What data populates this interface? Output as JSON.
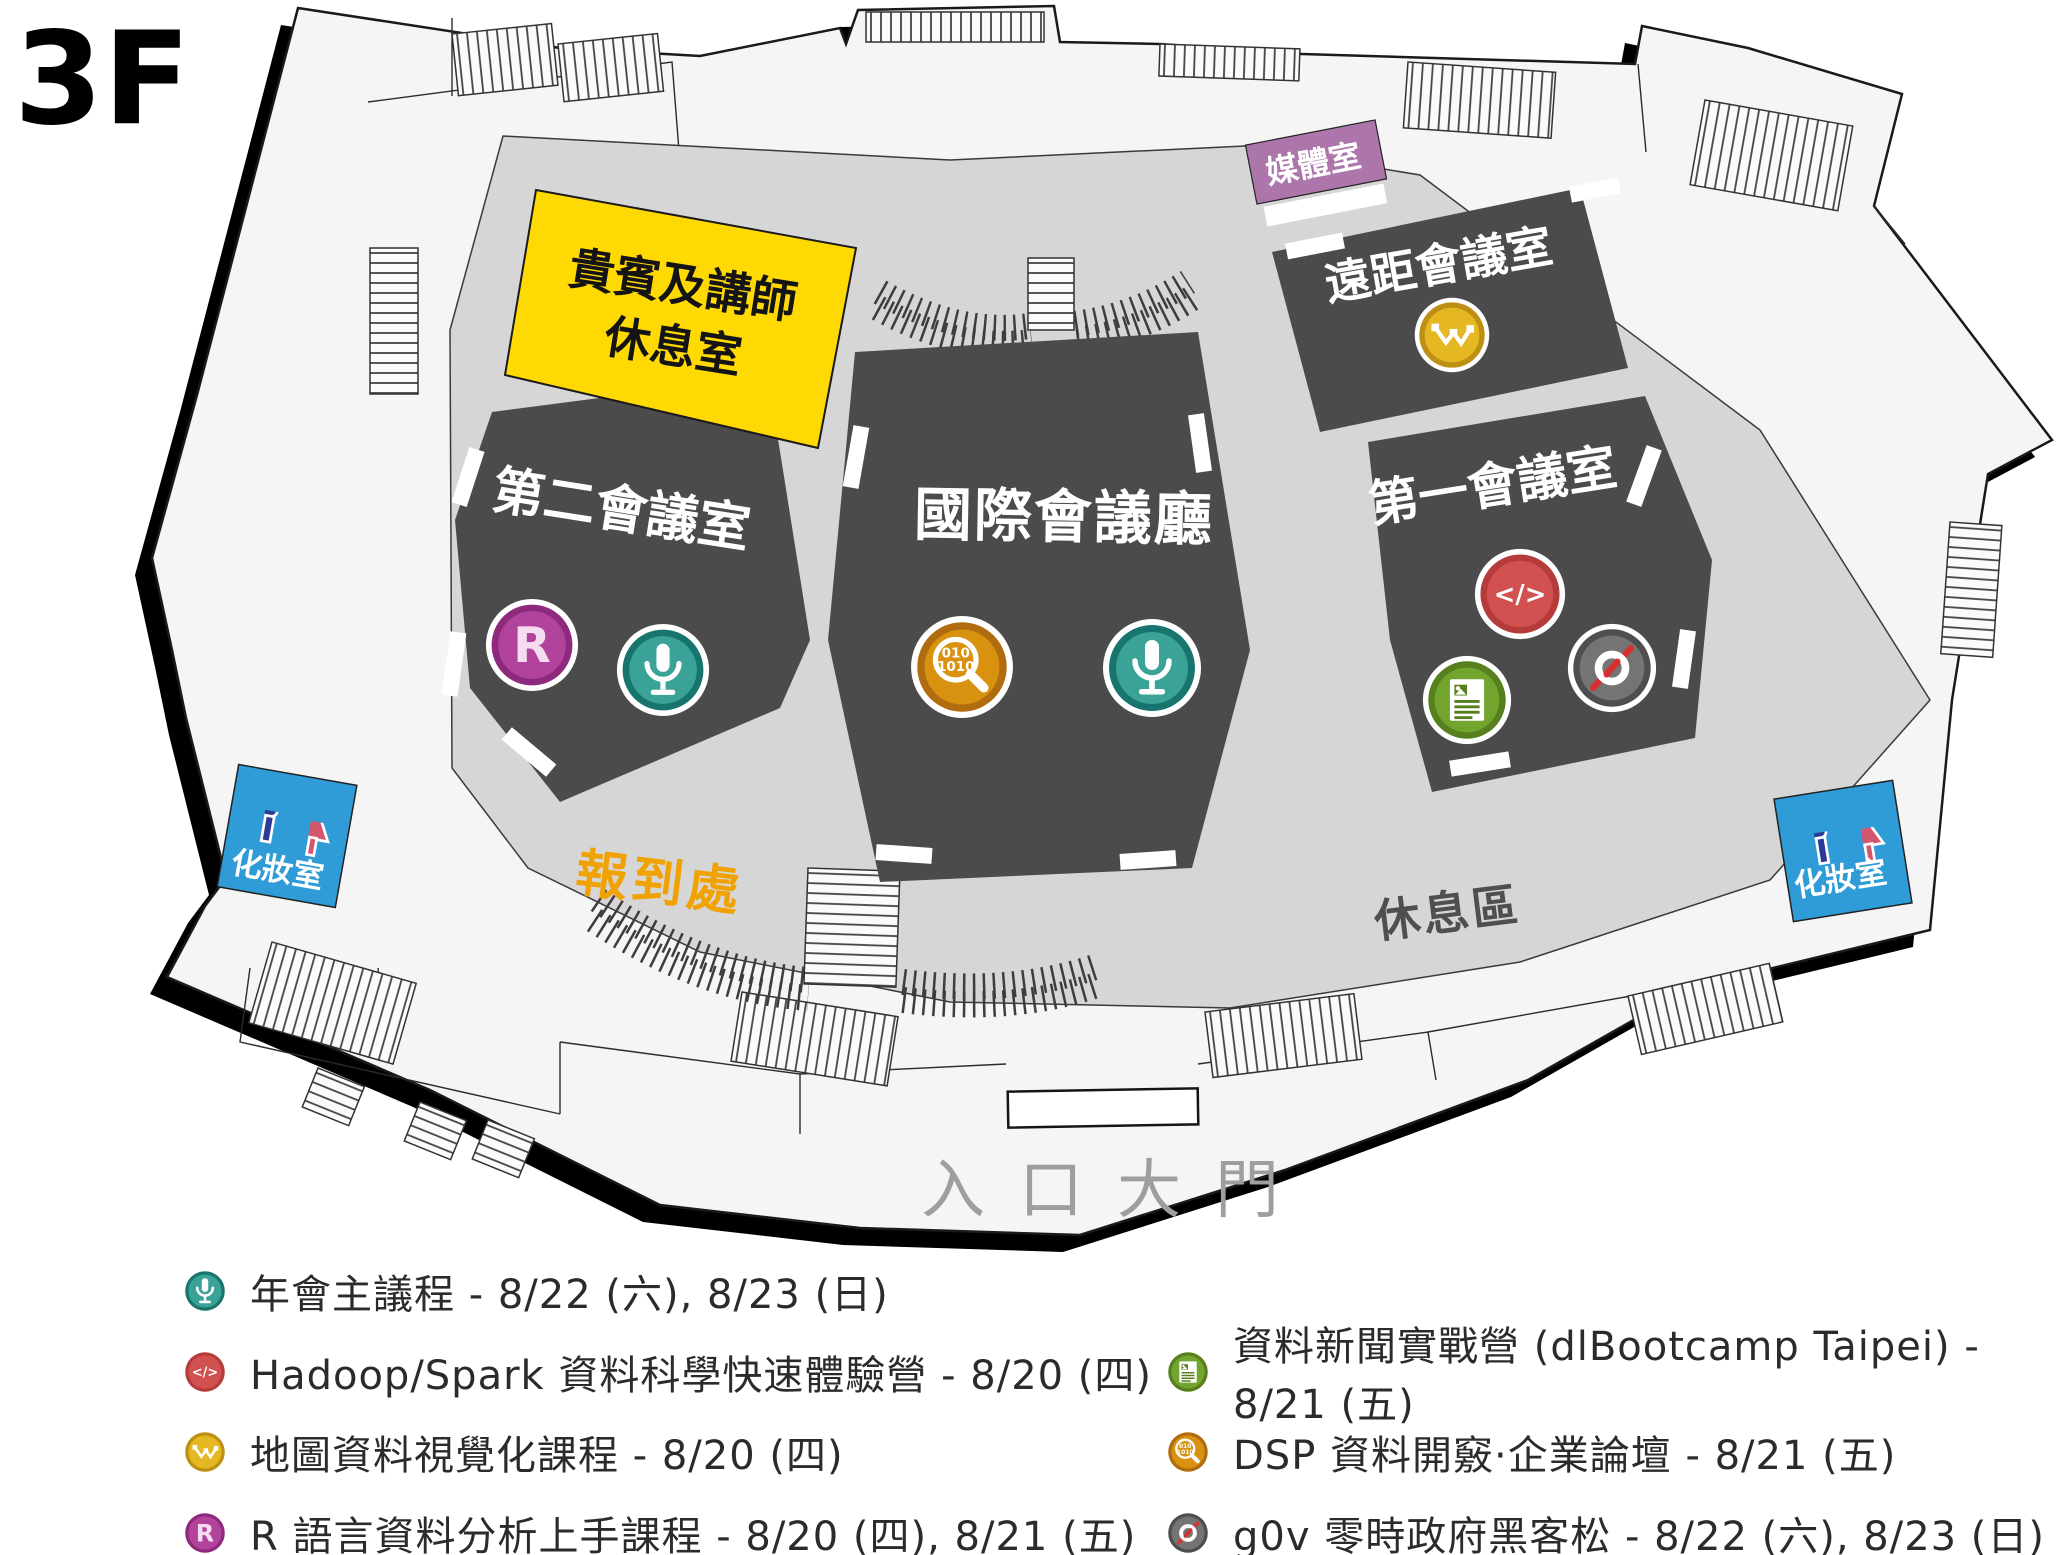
{
  "floor_label": "3F",
  "rooms": {
    "vip_lounge": {
      "line1": "貴賓及講師",
      "line2": "休息室",
      "color": "#ffd903"
    },
    "media_room": {
      "label": "媒體室",
      "color": "#ad76ab"
    },
    "remote_meeting_room": {
      "label": "遠距會議室",
      "icons": [
        "map-viz-icon"
      ]
    },
    "second_meeting_room": {
      "label": "第二會議室",
      "icons": [
        "r-lang-icon",
        "mic-icon"
      ]
    },
    "international_hall": {
      "label": "國際會議廳",
      "icons": [
        "data-explore-icon",
        "mic-icon"
      ]
    },
    "first_meeting_room": {
      "label": "第一會議室",
      "icons": [
        "code-icon",
        "news-icon",
        "g0v-icon"
      ]
    },
    "restroom_left": {
      "label": "化妝室",
      "color": "#2f9cd8"
    },
    "restroom_right": {
      "label": "化妝室",
      "color": "#2f9cd8"
    },
    "registration": {
      "label": "報到處",
      "color": "#f0a202"
    },
    "rest_area": {
      "label": "休息區"
    },
    "entrance": {
      "label": "入口大門"
    }
  },
  "icon_colors": {
    "mic-icon": "#3aa297",
    "r-lang-icon": "#b2439c",
    "map-viz-icon": "#e5b722",
    "data-explore-icon": "#d8920f",
    "code-icon": "#d15151",
    "news-icon": "#71a52e",
    "g0v-icon": "#747474"
  },
  "legend": {
    "left": [
      {
        "icon": "mic-icon",
        "text": "年會主議程 - 8/22 (六), 8/23 (日)"
      },
      {
        "icon": "code-icon",
        "text": "Hadoop/Spark 資料科學快速體驗營 - 8/20 (四)"
      },
      {
        "icon": "map-viz-icon",
        "text": "地圖資料視覺化課程 - 8/20 (四)"
      },
      {
        "icon": "r-lang-icon",
        "text": "R 語言資料分析上手課程 - 8/20 (四), 8/21 (五)"
      }
    ],
    "right": [
      {
        "icon": "news-icon",
        "text": "資料新聞實戰營 (dlBootcamp Taipei) - 8/21 (五)"
      },
      {
        "icon": "data-explore-icon",
        "text": "DSP 資料開竅·企業論壇 - 8/21 (五)"
      },
      {
        "icon": "g0v-icon",
        "text": "g0v 零時政府黑客松 - 8/22 (六), 8/23 (日)"
      }
    ]
  }
}
